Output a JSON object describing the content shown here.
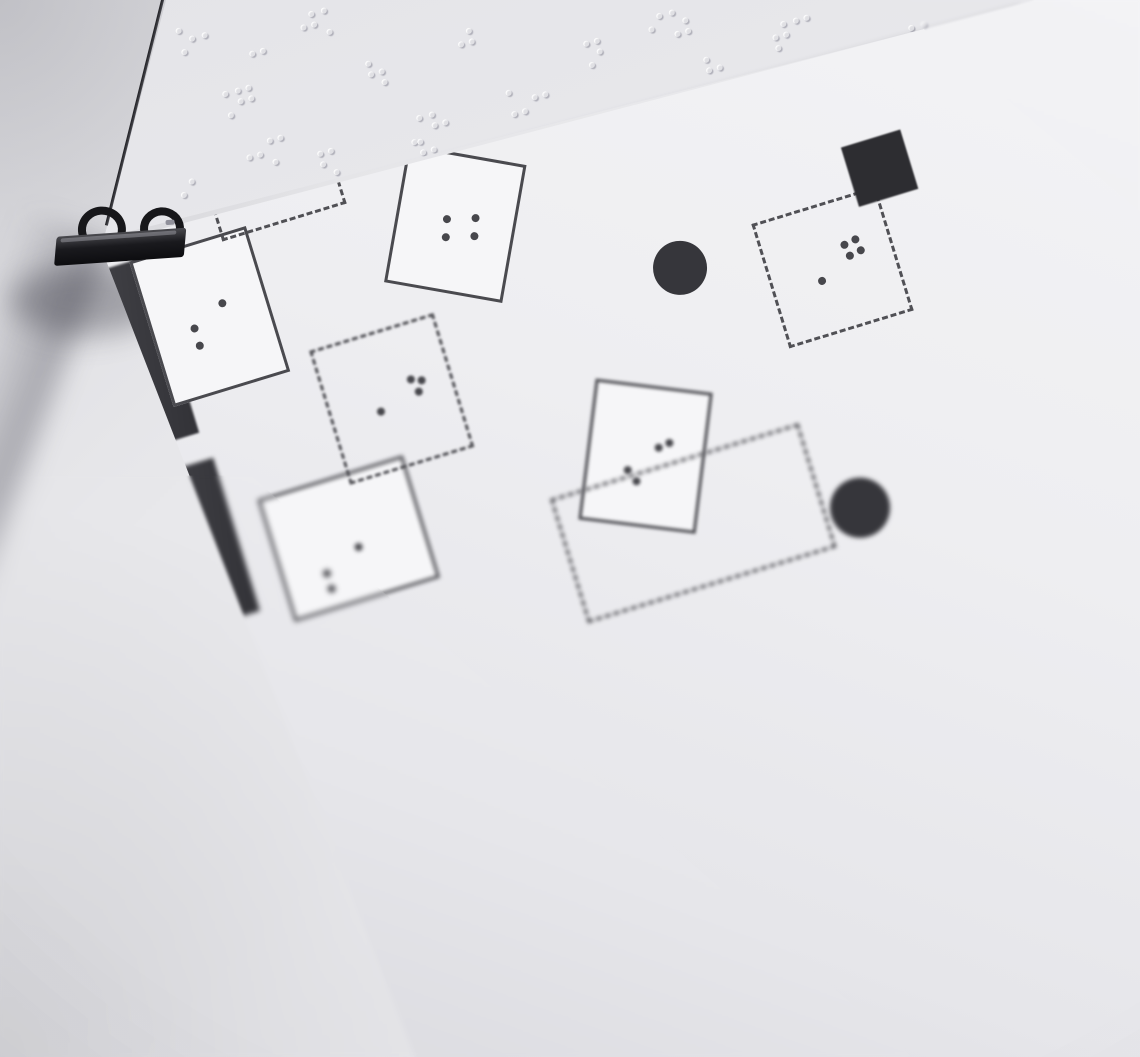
{
  "title": {
    "line1": "Lageplan zur Ausstellung",
    "line2": "\"Berg und Tal\""
  },
  "colors": {
    "desk": "#e7e7ea",
    "behind_sheet": "#e8e8ec",
    "main_sheet": "#efeff2",
    "ink": "#47474c",
    "wall": "#3c3c41",
    "outline": "#4a4a4f",
    "clip_black": "#17171a",
    "emboss": "#e0e0e4"
  },
  "plan": {
    "origin": {
      "x": 245,
      "y": 460
    },
    "rotation_deg": -17,
    "shapes": [
      {
        "type": "line",
        "name": "plan-border-top-outer",
        "u": -45,
        "v": -37,
        "w": 1050,
        "h": 1.8,
        "color": "#9b9b9f"
      },
      {
        "type": "line",
        "name": "plan-border-top-inner",
        "u": -45,
        "v": -29,
        "w": 1050,
        "h": 2.6,
        "color": "#55555a"
      },
      {
        "type": "line",
        "name": "plan-border-left",
        "u": -31,
        "v": -29,
        "w": 2.6,
        "h": 720,
        "color": "#5a5a60",
        "blur": 0.5
      },
      {
        "type": "wall",
        "name": "wall-top-corner",
        "u": -22,
        "v": -18,
        "w": 144,
        "h": 30
      },
      {
        "type": "wall",
        "name": "wall-top-mid",
        "u": 498,
        "v": -18,
        "w": 194,
        "h": 28
      },
      {
        "type": "wall",
        "name": "wall-top-mid-step",
        "u": 498,
        "v": 8,
        "w": 20,
        "h": 14
      },
      {
        "type": "wall",
        "name": "wall-top-wedge-1",
        "u": 792,
        "v": -18,
        "w": 26,
        "h": 24
      },
      {
        "type": "wall",
        "name": "wall-top-wedge-2",
        "u": 895,
        "v": -18,
        "w": 16,
        "h": 22
      },
      {
        "type": "wall",
        "name": "wall-left-upper",
        "u": -22,
        "v": -18,
        "w": 30,
        "h": 340
      },
      {
        "type": "wall",
        "name": "wall-left-mid",
        "u": -22,
        "v": 322,
        "w": 30,
        "h": 240,
        "blur": 1.5
      },
      {
        "type": "wall",
        "name": "wall-left-lower",
        "u": -18,
        "v": 560,
        "w": 46,
        "h": 160,
        "blur": 2.8
      },
      {
        "type": "wall",
        "name": "wall-left-block-1",
        "u": -22,
        "v": 58,
        "w": 74,
        "h": 170
      },
      {
        "type": "wall",
        "name": "wall-left-block-2",
        "u": -22,
        "v": 288,
        "w": 86,
        "h": 184,
        "blur": 1
      },
      {
        "type": "wall",
        "name": "wall-left-block-3",
        "u": -12,
        "v": 500,
        "w": 82,
        "h": 160,
        "blur": 2.2
      },
      {
        "type": "hatch",
        "name": "hatched-exhibit-bar",
        "u": 148,
        "v": 20,
        "w": 252,
        "h": 70,
        "window": {
          "u": 206,
          "v": 28,
          "w": 100,
          "h": 54,
          "dots": [
            [
              28,
              30
            ],
            [
              56,
              10
            ],
            [
              64,
              24
            ]
          ]
        }
      },
      {
        "type": "hatch",
        "name": "hatched-exhibit-right",
        "u": 792,
        "v": 174,
        "w": 92,
        "h": 92,
        "blur": 0.5,
        "window": {
          "u": 814,
          "v": 196,
          "w": 48,
          "h": 48,
          "dots": [
            [
              14,
              12
            ],
            [
              28,
              26
            ]
          ]
        }
      },
      {
        "type": "room",
        "name": "exhibit-room-entry",
        "u": -22,
        "v": 56,
        "w": 162,
        "h": 112,
        "dots": [
          [
            54,
            58
          ],
          [
            54,
            76
          ],
          [
            98,
            44
          ]
        ]
      },
      {
        "type": "room",
        "name": "exhibit-room-left",
        "u": 47,
        "v": 288,
        "w": 122,
        "h": 152,
        "dots": [
          [
            36,
            76
          ],
          [
            36,
            94
          ],
          [
            70,
            60
          ]
        ]
      },
      {
        "type": "room",
        "name": "exhibit-room-bottom",
        "u": 100,
        "v": 553,
        "w": 152,
        "h": 128,
        "blur": 2,
        "dots": [
          [
            38,
            84
          ],
          [
            38,
            100
          ],
          [
            76,
            68
          ]
        ]
      },
      {
        "type": "room",
        "name": "exhibit-room-tilted-1",
        "u": 310,
        "v": 277,
        "w": 120,
        "h": 140,
        "rot": 27,
        "dots": [
          [
            44,
            60
          ],
          [
            46,
            78
          ],
          [
            72,
            54
          ],
          [
            74,
            72
          ]
        ]
      },
      {
        "type": "room",
        "name": "exhibit-room-tilted-2",
        "u": 425,
        "v": 554,
        "w": 118,
        "h": 142,
        "rot": 24,
        "blur": 1.5,
        "dots": [
          [
            36,
            80
          ],
          [
            46,
            90
          ],
          [
            64,
            54
          ],
          [
            74,
            48
          ]
        ]
      },
      {
        "type": "room",
        "name": "exhibit-square-top-1",
        "u": 685,
        "v": -20,
        "w": 105,
        "h": 98,
        "dots": [
          [
            32,
            50
          ],
          [
            66,
            30
          ],
          [
            70,
            44
          ]
        ]
      },
      {
        "type": "room",
        "name": "exhibit-square-top-2",
        "u": 818,
        "v": -24,
        "w": 100,
        "h": 94,
        "dots": [
          [
            30,
            46
          ],
          [
            62,
            28
          ],
          [
            76,
            25
          ]
        ]
      },
      {
        "type": "room",
        "name": "exhibit-square-top-3",
        "u": 915,
        "v": -26,
        "w": 98,
        "h": 92,
        "dots": [
          [
            28,
            44
          ],
          [
            58,
            28
          ]
        ]
      },
      {
        "type": "dashed",
        "name": "dashed-area-1",
        "u": 142,
        "v": 162,
        "w": 130,
        "h": 134,
        "dots": [
          [
            48,
            64
          ],
          [
            80,
            44
          ],
          [
            90,
            48
          ],
          [
            84,
            58
          ]
        ]
      },
      {
        "type": "dashed",
        "name": "dashed-area-2",
        "u": 193,
        "v": 426,
        "w": 130,
        "h": 140,
        "blur": 1.2,
        "dots": [
          [
            44,
            72
          ],
          [
            82,
            50
          ],
          [
            92,
            54
          ],
          [
            86,
            64
          ]
        ]
      },
      {
        "type": "dashed",
        "name": "dashed-area-3",
        "u": 653,
        "v": 434,
        "w": 130,
        "h": 130,
        "dots": [
          [
            44,
            68
          ],
          [
            76,
            40
          ],
          [
            88,
            38
          ],
          [
            78,
            52
          ],
          [
            90,
            50
          ]
        ]
      },
      {
        "type": "dashed",
        "name": "dashed-area-4",
        "u": 380,
        "v": 638,
        "w": 260,
        "h": 130,
        "blur": 2
      },
      {
        "type": "solid",
        "name": "pillar-square-1",
        "u": 458,
        "v": 173,
        "w": 54,
        "h": 54
      },
      {
        "type": "solid",
        "name": "pillar-square-2",
        "u": 695,
        "v": 151,
        "w": 56,
        "h": 56
      },
      {
        "type": "solid",
        "name": "pillar-square-3",
        "u": 761,
        "v": 387,
        "w": 62,
        "h": 62,
        "blur": 0.8
      },
      {
        "type": "circle",
        "name": "pillar-round-1",
        "u": 545,
        "v": 428,
        "r": 27
      },
      {
        "type": "circle",
        "name": "pillar-round-2",
        "u": 644,
        "v": 707,
        "r": 30,
        "blur": 2.5
      },
      {
        "type": "braille",
        "name": "braille-line-1",
        "u": 295,
        "v": -142,
        "cells": [
          "46",
          "123",
          "1",
          "1245",
          "15",
          "1234",
          "123",
          "1",
          "1345",
          "",
          "1356",
          "136",
          "1235",
          "",
          "16",
          "234",
          "234"
        ]
      },
      {
        "type": "braille",
        "name": "braille-line-2",
        "u": 190,
        "v": -95,
        "cells": [
          "2356",
          "12",
          "15",
          "1235",
          "1245",
          "",
          "136",
          "1345",
          "145",
          "",
          "2345",
          "1",
          "123",
          "2356"
        ]
      },
      {
        "type": "braille",
        "name": "braille-line-1-embossed-tail",
        "faint": true,
        "u": 745,
        "v": -142,
        "cells": [
          "2345",
          "15",
          "123",
          "123",
          "136",
          "1345",
          "1245"
        ]
      }
    ]
  },
  "emboss": {
    "clusters": [
      {
        "x": 178,
        "y": 22,
        "cells": [
          "135",
          "2"
        ]
      },
      {
        "x": 214,
        "y": 88,
        "cells": [
          "46",
          "1245"
        ]
      },
      {
        "x": 252,
        "y": 48,
        "cells": [
          "14"
        ]
      },
      {
        "x": 300,
        "y": 8,
        "cells": [
          "245",
          "13"
        ]
      },
      {
        "x": 368,
        "y": 58,
        "cells": [
          "1256"
        ]
      },
      {
        "x": 408,
        "y": 112,
        "cells": [
          "34",
          "125"
        ]
      },
      {
        "x": 458,
        "y": 28,
        "cells": [
          "245"
        ]
      },
      {
        "x": 508,
        "y": 84,
        "cells": [
          "136",
          "25"
        ]
      },
      {
        "x": 586,
        "y": 38,
        "cells": [
          "1345"
        ]
      },
      {
        "x": 648,
        "y": 10,
        "cells": [
          "24",
          "1356"
        ]
      },
      {
        "x": 706,
        "y": 54,
        "cells": [
          "125"
        ]
      },
      {
        "x": 772,
        "y": 18,
        "cells": [
          "2345",
          "14"
        ]
      },
      {
        "x": 838,
        "y": 58,
        "cells": [
          "135"
        ]
      },
      {
        "x": 900,
        "y": 22,
        "cells": [
          "456",
          "12"
        ]
      },
      {
        "x": 246,
        "y": 138,
        "cells": [
          "25",
          "134"
        ]
      },
      {
        "x": 320,
        "y": 148,
        "cells": [
          "1246"
        ]
      },
      {
        "x": 178,
        "y": 168,
        "cells": [
          "35"
        ]
      },
      {
        "x": 420,
        "y": 136,
        "cells": [
          "125"
        ]
      }
    ]
  }
}
